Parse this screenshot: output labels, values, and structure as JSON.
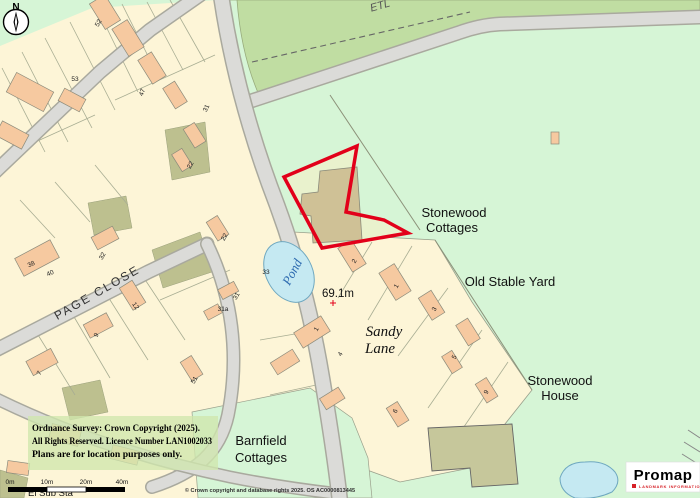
{
  "map": {
    "region_labels": {
      "etl": "ETL",
      "stonewood_cottages_1": "Stonewood",
      "stonewood_cottages_2": "Cottages",
      "old_stable_yard": "Old Stable Yard",
      "sandy_lane_1": "Sandy",
      "sandy_lane_2": "Lane",
      "stonewood_house_1": "Stonewood",
      "stonewood_house_2": "House",
      "barnfield_cottages_1": "Barnfield",
      "barnfield_cottages_2": "Cottages",
      "page_close": "PAGE CLOSE",
      "pond": "Pond",
      "el_sub_sta": "El Sub Sta",
      "spot_height": "69.1m"
    },
    "compass": {
      "north_label": "N"
    },
    "house_numbers": [
      {
        "t": "52",
        "x": 100,
        "y": 24,
        "r": -60
      },
      {
        "t": "53",
        "x": 75,
        "y": 81,
        "r": 0
      },
      {
        "t": "47",
        "x": 144,
        "y": 93,
        "r": -70
      },
      {
        "t": "31",
        "x": 208,
        "y": 109,
        "r": -65
      },
      {
        "t": "22",
        "x": 192,
        "y": 166,
        "r": -60
      },
      {
        "t": "38",
        "x": 32,
        "y": 266,
        "r": -25
      },
      {
        "t": "40",
        "x": 51,
        "y": 275,
        "r": -25
      },
      {
        "t": "32",
        "x": 104,
        "y": 257,
        "r": -60
      },
      {
        "t": "22",
        "x": 226,
        "y": 238,
        "r": -60
      },
      {
        "t": "12",
        "x": 134,
        "y": 307,
        "r": 55
      },
      {
        "t": "31a",
        "x": 223,
        "y": 311,
        "r": 0
      },
      {
        "t": "31",
        "x": 238,
        "y": 297,
        "r": -60
      },
      {
        "t": "9",
        "x": 98,
        "y": 336,
        "r": -60
      },
      {
        "t": "7",
        "x": 41,
        "y": 374,
        "r": -60
      },
      {
        "t": "51",
        "x": 196,
        "y": 381,
        "r": -60
      },
      {
        "t": "33",
        "x": 266,
        "y": 274,
        "r": 0
      },
      {
        "t": "2",
        "x": 356,
        "y": 262,
        "r": -60
      },
      {
        "t": "1",
        "x": 398,
        "y": 287,
        "r": -60
      },
      {
        "t": "3",
        "x": 436,
        "y": 310,
        "r": -60
      },
      {
        "t": "1",
        "x": 318,
        "y": 330,
        "r": -60
      },
      {
        "t": "4",
        "x": 342,
        "y": 355,
        "r": -60
      },
      {
        "t": "5",
        "x": 456,
        "y": 358,
        "r": -60
      },
      {
        "t": "6",
        "x": 397,
        "y": 412,
        "r": -60
      },
      {
        "t": "9",
        "x": 488,
        "y": 393,
        "r": -60
      }
    ],
    "colors": {
      "boundary_red": "#e2001a",
      "field_green": "#c0dda2",
      "open_green": "#d6f5d6",
      "residential_cream": "#fdf5d7",
      "building_orange": "#f6c9a0",
      "pond_blue": "#c5e9f2",
      "road_grey": "#dbdbd8"
    }
  },
  "footer": {
    "copyright_box": {
      "line1": "Ordnance Survey: Crown Copyright (2025).",
      "line2": "All Rights Reserved. Licence Number LAN1002033",
      "line3": "Plans are for location purposes only."
    },
    "scale_bar": {
      "labels": [
        "0m",
        "10m",
        "20m",
        "40m"
      ]
    },
    "credit": "© Crown copyright and database rights 2025. OS AC0000813445",
    "promap": {
      "brand": "Promap",
      "tagline": "LANDMARK INFORMATION"
    }
  }
}
